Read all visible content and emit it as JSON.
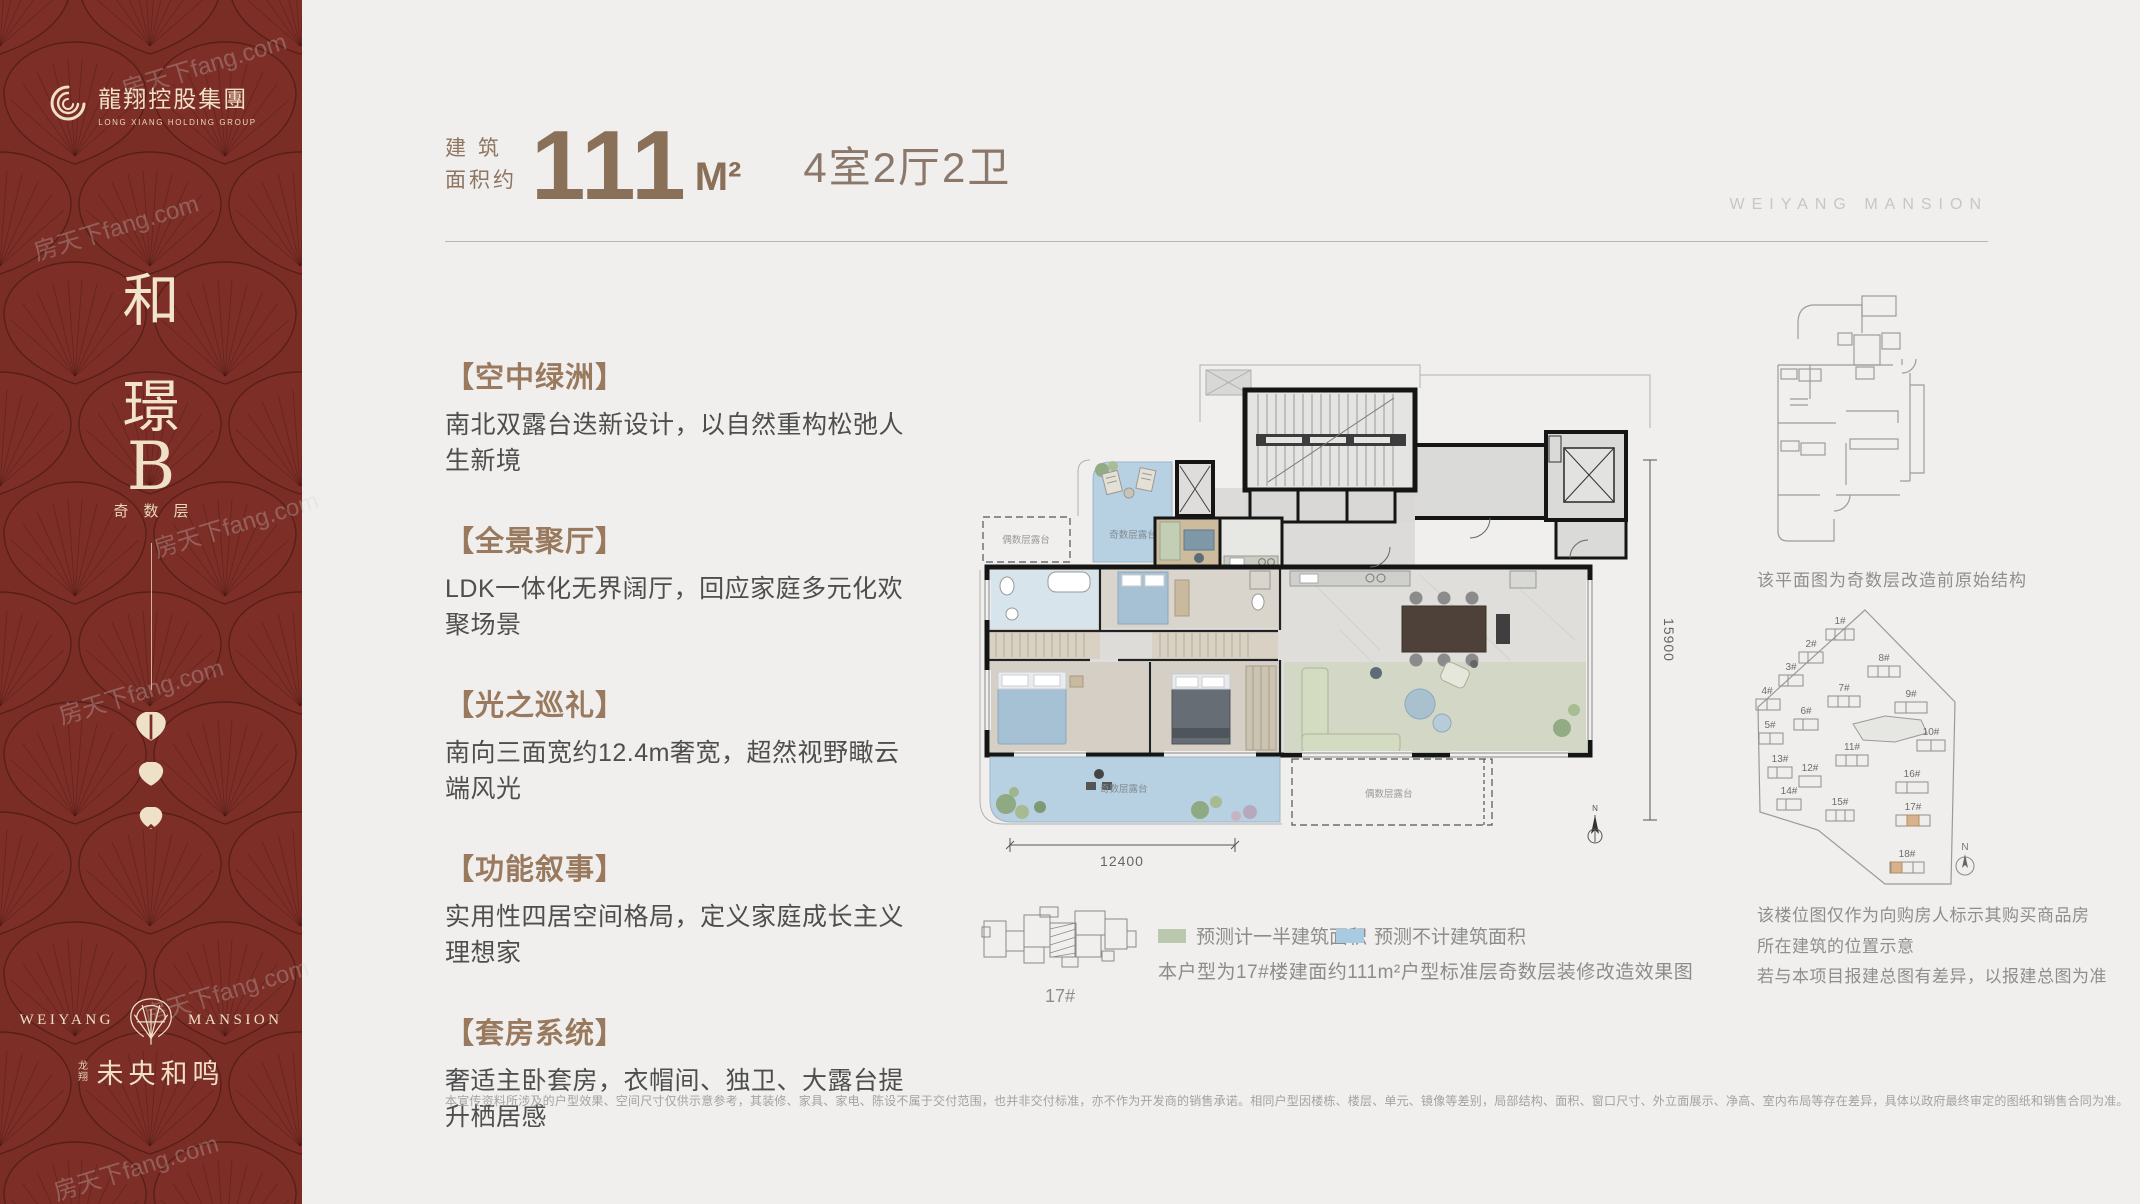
{
  "brand": {
    "group_logo_cn": "龍翔控股集團",
    "group_logo_en": "LONG XIANG HOLDING GROUP",
    "mansion_en_left": "WEIYANG",
    "mansion_en_right": "MANSION",
    "mansion_cn_prefix": "龙翔",
    "mansion_cn": "未央和鸣",
    "header_brand_en": "WEIYANG MANSION",
    "accent_red": "#7a2d25",
    "accent_cream": "#efe0c8",
    "accent_brown": "#8a7058"
  },
  "sidebar": {
    "title_char_1": "和",
    "title_char_2": "璟",
    "unit_letter": "B",
    "floor_tag": "奇数层"
  },
  "header": {
    "area_label_line1": "建 筑",
    "area_label_line2": "面积约",
    "area_value": "111",
    "area_unit": "M²",
    "room_layout": "4室2厅2卫"
  },
  "features": [
    {
      "title": "【空中绿洲】",
      "desc": "南北双露台迭新设计，以自然重构松弛人生新境"
    },
    {
      "title": "【全景聚厅】",
      "desc": "LDK一体化无界阔厅，回应家庭多元化欢聚场景"
    },
    {
      "title": "【光之巡礼】",
      "desc": "南向三面宽约12.4m奢宽，超然视野瞰云端风光"
    },
    {
      "title": "【功能叙事】",
      "desc": "实用性四居空间格局，定义家庭成长主义理想家"
    },
    {
      "title": "【套房系统】",
      "desc": "奢适主卧套房，衣帽间、独卫、大露台提升栖居感"
    }
  ],
  "plan": {
    "dim_width": "12400",
    "dim_height": "15900",
    "terrace_odd": "奇数层露台",
    "terrace_even": "偶数层露台",
    "compass_n": "N"
  },
  "legend": {
    "half_area_label": "预测计一半建筑面积",
    "half_area_color": "#bac8ad",
    "excluded_label": "预测不计建筑面积",
    "excluded_color": "#a9cbe2",
    "caption": "本户型为17#楼建面约111m²户型标准层奇数层装修改造效果图",
    "building_tag": "17#"
  },
  "right_panel": {
    "original_plan_caption": "该平面图为奇数层改造前原始结构",
    "site_note_line1": "该楼位图仅作为向购房人标示其购买商品房",
    "site_note_line2": "所在建筑的位置示意",
    "site_note_line3": "若与本项目报建总图有差异，以报建总图为准",
    "buildings": [
      "1#",
      "2#",
      "3#",
      "4#",
      "5#",
      "6#",
      "7#",
      "8#",
      "9#",
      "10#",
      "11#",
      "12#",
      "13#",
      "14#",
      "15#",
      "16#",
      "17#",
      "18#"
    ]
  },
  "footer": {
    "disclaimer": "本宣传资料所涉及的户型效果、空间尺寸仅供示意参考，其装修、家具、家电、陈设不属于交付范围，也并非交付标准，亦不作为开发商的销售承诺。相同户型因楼栋、楼层、单元、镜像等差别，局部结构、面积、窗口尺寸、外立面展示、净高、室内布局等存在差异，具体以政府最终审定的图纸和销售合同为准。"
  },
  "watermark": {
    "text": "房天下fang.com"
  }
}
